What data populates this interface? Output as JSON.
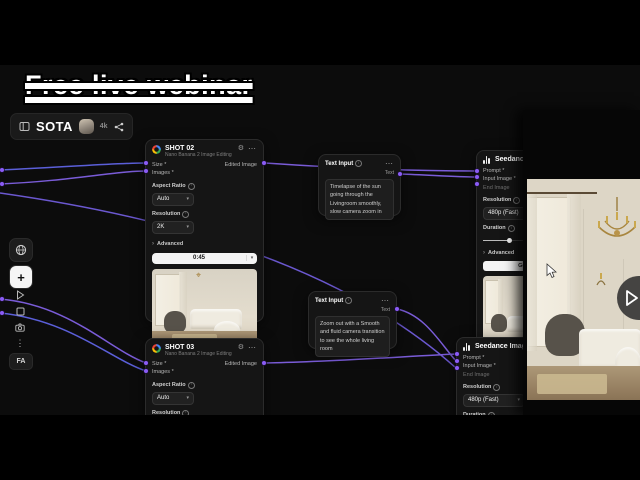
{
  "banner": {
    "text": "Free live webinar"
  },
  "topbar": {
    "app_name": "SOTA",
    "quality": "4k"
  },
  "toolbar": {
    "fa_label": "FA"
  },
  "glyphs": {
    "dots_h": "⋯",
    "dots_v": "⋮",
    "plus": "+",
    "chevron_down": "▾",
    "chevron_right": "›",
    "gear": "⚙",
    "info": "i"
  },
  "colors": {
    "accent": "#8b5cf6",
    "wire_purple": "#7a5cd8",
    "wire_blue": "#5b5fd9",
    "node_bg": "#151515"
  },
  "nodes": {
    "shot02": {
      "title": "SHOT 02",
      "subtitle": "Nano Banana 2 Image Editing",
      "size_label": "Size *",
      "images_label": "Images *",
      "output_label": "Edited Image",
      "aspect_label": "Aspect Ratio",
      "aspect_value": "Auto",
      "resolution_label": "Resolution",
      "resolution_value": "2K",
      "advanced_label": "Advanced",
      "duration_value": "0:45"
    },
    "shot03": {
      "title": "SHOT 03",
      "subtitle": "Nano Banana 2 Image Editing",
      "size_label": "Size *",
      "images_label": "Images *",
      "output_label": "Edited Image",
      "aspect_label": "Aspect Ratio",
      "aspect_value": "Auto",
      "resolution_label": "Resolution",
      "resolution_value": "2K"
    },
    "text1": {
      "title": "Text Input",
      "port_label": "Text",
      "value": "Timelapse of the sun going through the Livingroom smoothly, slow camera zoom in"
    },
    "text2": {
      "title": "Text Input",
      "port_label": "Text",
      "value": "Zoom out with a Smooth and fluid camera transition to see the whole living room"
    },
    "seedance1": {
      "title": "Seedance Image-to-Video",
      "prompt_label": "Prompt *",
      "input_image_label": "Input Image *",
      "end_image_label": "End Image",
      "resolution_label": "Resolution",
      "resolution_value": "480p (Fast)",
      "duration_label": "Duration",
      "advanced_label": "Advanced",
      "generate_label": "Generate"
    },
    "seedance2": {
      "title": "Seedance Image-to-...",
      "prompt_label": "Prompt *",
      "input_image_label": "Input Image *",
      "end_image_label": "End Image",
      "resolution_label": "Resolution",
      "resolution_value": "480p (Fast)",
      "duration_label": "Duration"
    }
  }
}
